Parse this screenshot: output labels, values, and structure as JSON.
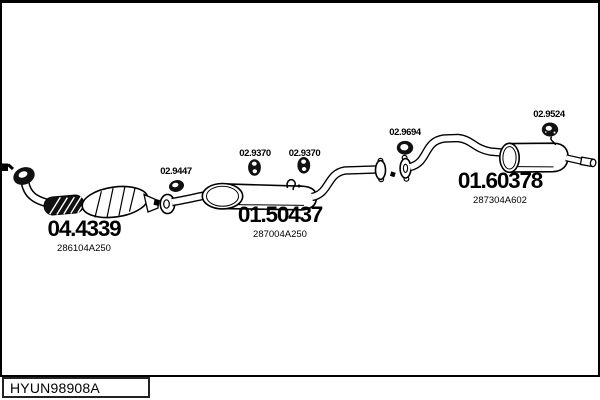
{
  "parts": [
    {
      "code": "04.4339",
      "ref": "286104A250"
    },
    {
      "code": "02.9447"
    },
    {
      "code": "02.9370"
    },
    {
      "code": "02.9370"
    },
    {
      "code": "01.50437",
      "ref": "287004A250"
    },
    {
      "code": "02.9694"
    },
    {
      "code": "02.9524"
    },
    {
      "code": "01.60378",
      "ref": "287304A602"
    }
  ],
  "footer": {
    "code": "HYUN98908A"
  },
  "colors": {
    "line": "#000000",
    "fill": "#ffffff",
    "dark": "#111111"
  }
}
